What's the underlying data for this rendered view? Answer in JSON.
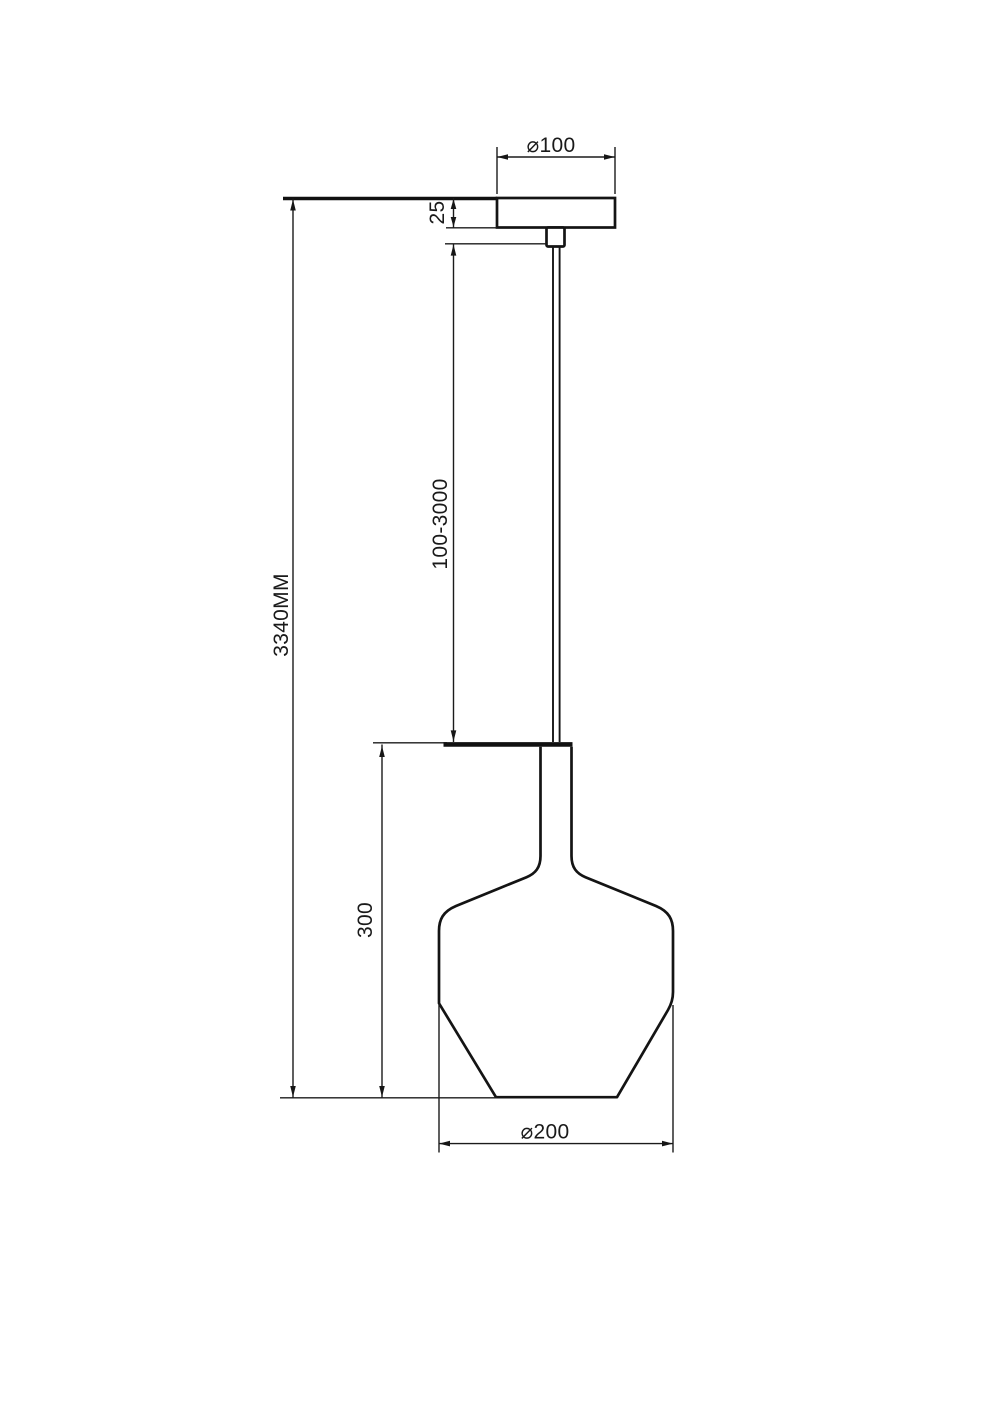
{
  "drawing": {
    "type": "technical-dimension-drawing",
    "subject": "pendant-lamp-side-elevation",
    "colors": {
      "background": "#ffffff",
      "line": "#141414",
      "text": "#1a1a1a"
    },
    "labels": {
      "canopy_diameter": "⌀100",
      "canopy_height": "25",
      "suspension_length": "100-3000",
      "total_height": "3340MM",
      "shade_height": "300",
      "shade_diameter": "⌀200"
    }
  }
}
